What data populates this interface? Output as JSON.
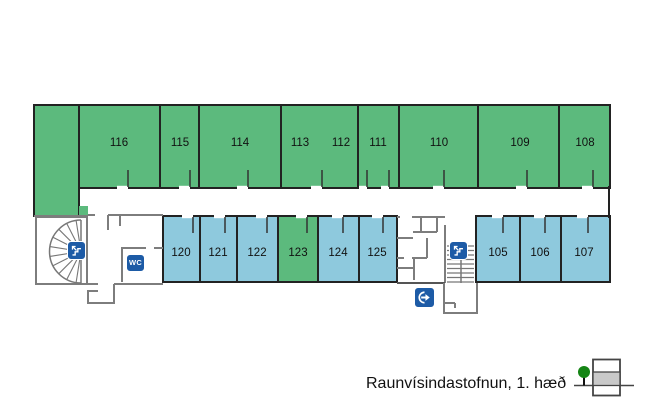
{
  "caption": "Raunvísindastofnun, 1. hæð",
  "top_rooms": [
    {
      "label": "116"
    },
    {
      "label": "115"
    },
    {
      "label": "114"
    },
    {
      "label": "113"
    },
    {
      "label": "112"
    },
    {
      "label": "111"
    },
    {
      "label": "110"
    },
    {
      "label": "109"
    },
    {
      "label": "108"
    }
  ],
  "bottom_rooms": [
    {
      "label": "120"
    },
    {
      "label": "121"
    },
    {
      "label": "122"
    },
    {
      "label": "123"
    },
    {
      "label": "124"
    },
    {
      "label": "125"
    },
    {
      "label": "105"
    },
    {
      "label": "106"
    },
    {
      "label": "107"
    }
  ],
  "icons": {
    "spiral_stairs": "stairs-icon",
    "wc": "wc-icon",
    "wc_label": "WC",
    "straight_stairs": "stairs-icon",
    "exit": "exit-arrow-icon",
    "legend_tree": "tree-icon",
    "legend_building": "floor-level-icon"
  },
  "colors": {
    "room_green": "#5cba7d",
    "room_blue": "#8ec9dd",
    "icon_blue": "#1d5ba6",
    "wall_dark": "#222222",
    "wall_gray": "#7d7d7d",
    "legend_tree_green": "#158515",
    "legend_floor_gray": "#c9c9c9"
  }
}
